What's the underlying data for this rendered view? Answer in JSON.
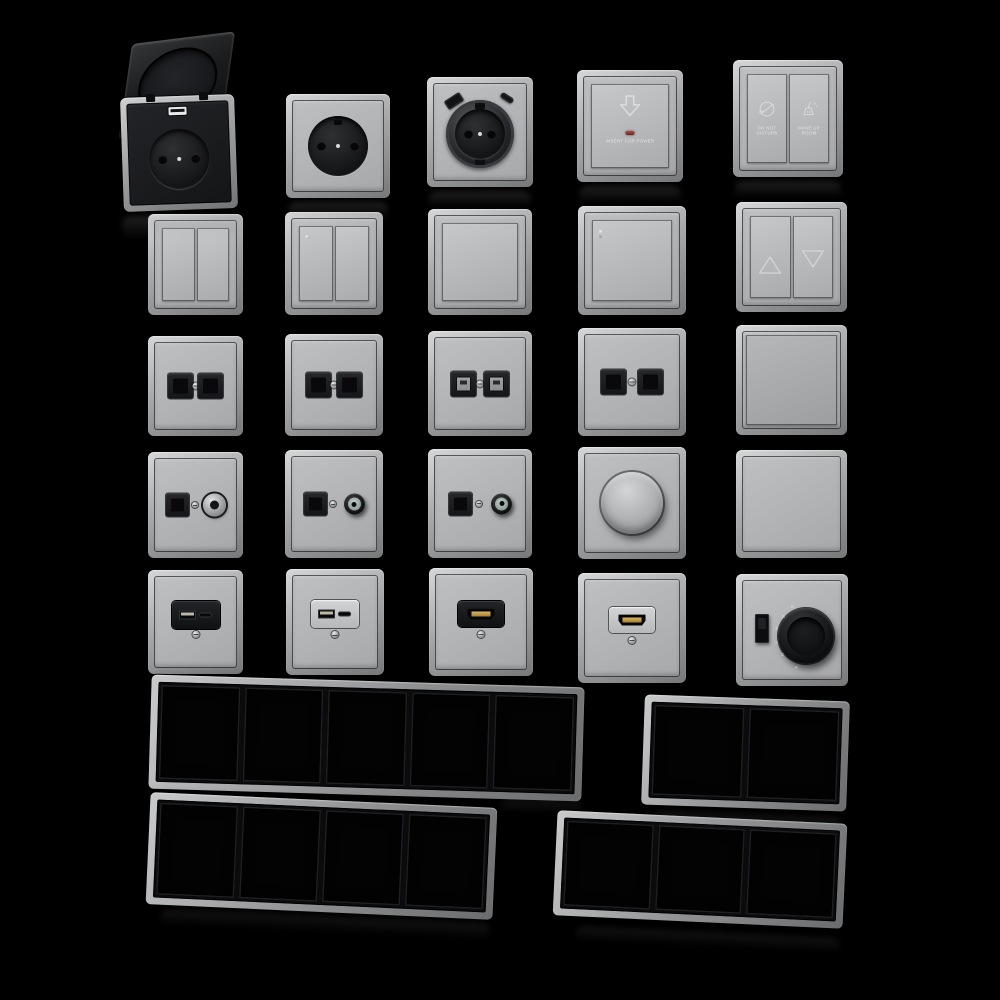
{
  "meta": {
    "description": "3D rendered catalog of modular silver-gray wall switches, power sockets, data and media outlets with empty multi-gang frames on a black background",
    "background": "#000000"
  },
  "palette": {
    "background": "#000000",
    "frame_silver_light": "#d6d7d9",
    "frame_silver": "#a7a8aa",
    "frame_silver_dark": "#77787a",
    "plate_gray": "#b4b5b7",
    "insert_black": "#141517",
    "hdmi_gold": "#c3a052",
    "led_red": "#93312b",
    "label_white": "#e8e9eb"
  },
  "texts": {
    "keycard_switch": {
      "label": "INSERT FOR POWER"
    },
    "service_switch": {
      "left_label": "DO NOT DISTURB",
      "right_label": "MAKE UP ROOM"
    },
    "thermostat": {
      "scale_marks": [
        "6",
        "5",
        "4",
        "3",
        "2"
      ],
      "bottom_mark": "✳"
    }
  },
  "icons": {
    "keycard": "arrow-down-icon",
    "service_left": "no-disturb-icon",
    "service_right": "broom-icon",
    "blind_left": "triangle-up-icon",
    "blind_right": "triangle-down-icon"
  },
  "rows": [
    {
      "name": "sockets-row",
      "items": [
        {
          "id": "flip-lid-socket",
          "label": "Schuko socket with open black flip lid and USB port"
        },
        {
          "id": "schuko-socket",
          "label": "Schuko socket with black center"
        },
        {
          "id": "schuko-socket-usb",
          "label": "Schuko socket with tilted USB-A and USB-C ports"
        },
        {
          "id": "keycard-power-switch",
          "label": "Key card power switch with red LED"
        },
        {
          "id": "hotel-service-switch",
          "label": "Do-not-disturb / make-up-room double switch"
        }
      ]
    },
    {
      "name": "switches-row",
      "items": [
        {
          "id": "double-rocker-switch",
          "label": "Double rocker switch"
        },
        {
          "id": "double-rocker-switch-indicator",
          "label": "Double rocker switch with indicator dot"
        },
        {
          "id": "single-rocker-switch",
          "label": "Single rocker switch"
        },
        {
          "id": "single-rocker-switch-indicator",
          "label": "Single rocker switch with indicator line"
        },
        {
          "id": "blind-control-switch",
          "label": "Blind control switch with up and down triangles"
        }
      ]
    },
    {
      "name": "data-sockets-row",
      "items": [
        {
          "id": "dual-data-socket-a",
          "label": "Dual data socket, black jacks"
        },
        {
          "id": "dual-data-socket-b",
          "label": "Dual data socket, black jacks"
        },
        {
          "id": "dual-data-socket-shuttered",
          "label": "Dual data socket with light shuttered jacks"
        },
        {
          "id": "dual-data-socket-c",
          "label": "Dual data socket, black jacks"
        },
        {
          "id": "blank-module-plate",
          "label": "Full-face blank module"
        }
      ]
    },
    {
      "name": "tv-sockets-row",
      "items": [
        {
          "id": "tv-data-socket-female",
          "label": "Data jack with female coax connector"
        },
        {
          "id": "tv-data-socket-male-a",
          "label": "Data jack with protruding male coax connector"
        },
        {
          "id": "tv-data-socket-male-b",
          "label": "Data jack with protruding male coax connector"
        },
        {
          "id": "rotary-dimmer",
          "label": "Rotary dimmer knob"
        },
        {
          "id": "blank-plate",
          "label": "Blank cover plate"
        }
      ]
    },
    {
      "name": "media-row",
      "items": [
        {
          "id": "usb-charger-black",
          "label": "USB-A + USB-C charger outlet, black insert"
        },
        {
          "id": "usb-charger-white",
          "label": "USB-A + USB-C charger outlet, light insert"
        },
        {
          "id": "hdmi-outlet-black",
          "label": "HDMI outlet, black insert, gold connector"
        },
        {
          "id": "hdmi-outlet-white",
          "label": "HDMI outlet, light insert, gold connector"
        },
        {
          "id": "thermostat-dial",
          "label": "Thermostat with black rotary dial, slider and numbered scale"
        }
      ]
    }
  ],
  "frames": [
    {
      "id": "frame-5-gang",
      "gangs": 5,
      "label": "Empty 5-gang frame"
    },
    {
      "id": "frame-2-gang",
      "gangs": 2,
      "label": "Empty 2-gang frame"
    },
    {
      "id": "frame-4-gang",
      "gangs": 4,
      "label": "Empty 4-gang frame"
    },
    {
      "id": "frame-3-gang",
      "gangs": 3,
      "label": "Empty 3-gang frame"
    }
  ]
}
